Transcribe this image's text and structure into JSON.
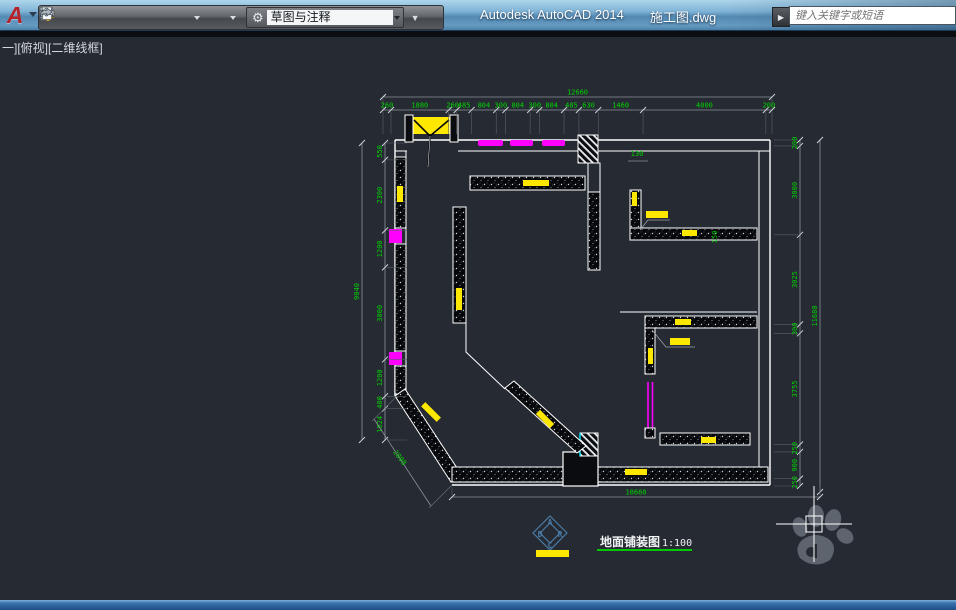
{
  "titlebar": {
    "app_title": "Autodesk AutoCAD 2014",
    "doc_title": "施工图.dwg",
    "search_placeholder": "键入关键字或短语",
    "search_go": "▶"
  },
  "quick_access": {
    "workspace": "草图与注释",
    "gear_glyph": "⚙",
    "collapse_glyph": "▼",
    "icons": [
      "new-file",
      "open-folder",
      "save",
      "save-as",
      "print",
      "undo",
      "redo"
    ]
  },
  "viewport": {
    "label": "一][俯视][二维线框]"
  },
  "plan": {
    "title": "地面铺装图",
    "scale": "1:100",
    "logo_letters": {
      "top": "A",
      "left": "D",
      "right": "R",
      "bottom": "C"
    },
    "dims": {
      "top_overall": "12660",
      "top": [
        "260",
        "1880",
        "260",
        "485",
        "804",
        "300",
        "804",
        "300",
        "804",
        "485",
        "630",
        "1460",
        "4000",
        "200"
      ],
      "left_overall": "9040",
      "left": [
        "550",
        "2300",
        "1200",
        "3000",
        "1200",
        "400",
        "1024"
      ],
      "right_overall": "11680",
      "right": [
        "200",
        "3000",
        "3025",
        "300",
        "3755",
        "250",
        "900",
        "250"
      ],
      "bottom_overall": "10660",
      "diagonal": "2898",
      "inline_width": "130",
      "inline_height": "150"
    }
  },
  "colors": {
    "dim_green": "#00d400",
    "magenta": "#ff00ff",
    "yellow": "#ffe800",
    "cyan": "#00e5ff",
    "wall_white": "#ffffff",
    "titlebar_blue": "#6ea3c8",
    "canvas_dark": "#262b33"
  }
}
